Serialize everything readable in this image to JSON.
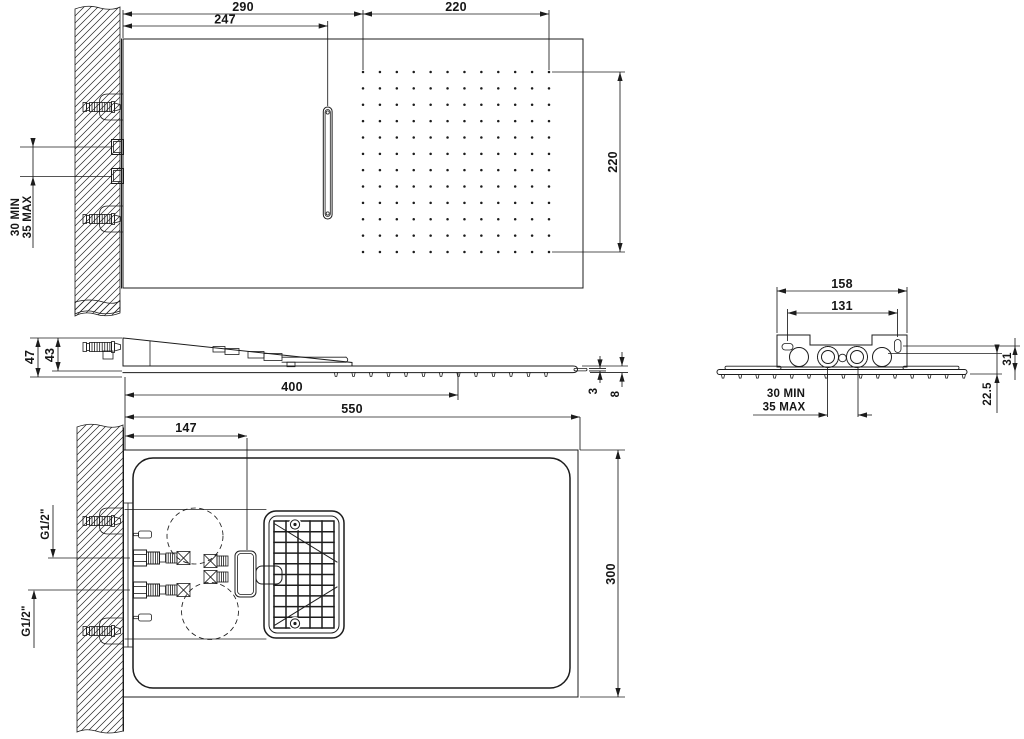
{
  "drawing_type": "shower-head installation dimensions",
  "colors": {
    "line": "#1c1c1c",
    "background": "#ffffff"
  },
  "views": {
    "front": {
      "dims": {
        "wall_to_grid": "290",
        "wall_to_slot": "247",
        "grid_width": "220",
        "grid_height": "220",
        "inlet_min": "30 MIN",
        "inlet_max": "35 MAX"
      },
      "nozzle_grid": {
        "cols": 12,
        "rows": 12
      }
    },
    "side": {
      "dims": {
        "total_depth": "47",
        "body_depth": "43",
        "nozzle_length": "400",
        "lip_thickness": "3",
        "plate_thickness": "8"
      }
    },
    "shared": {
      "dims": {
        "total_length": "550"
      }
    },
    "plan": {
      "dims": {
        "connector_offset": "147",
        "body_width": "300",
        "thread_upper": "G1/2\"",
        "thread_lower": "G1/2\""
      }
    },
    "rear": {
      "dims": {
        "bracket_width": "158",
        "slot_spacing": "131",
        "slot_height": "31",
        "inlet_height": "22.5",
        "inlet_min": "30 MIN",
        "inlet_max": "35 MAX"
      }
    }
  }
}
